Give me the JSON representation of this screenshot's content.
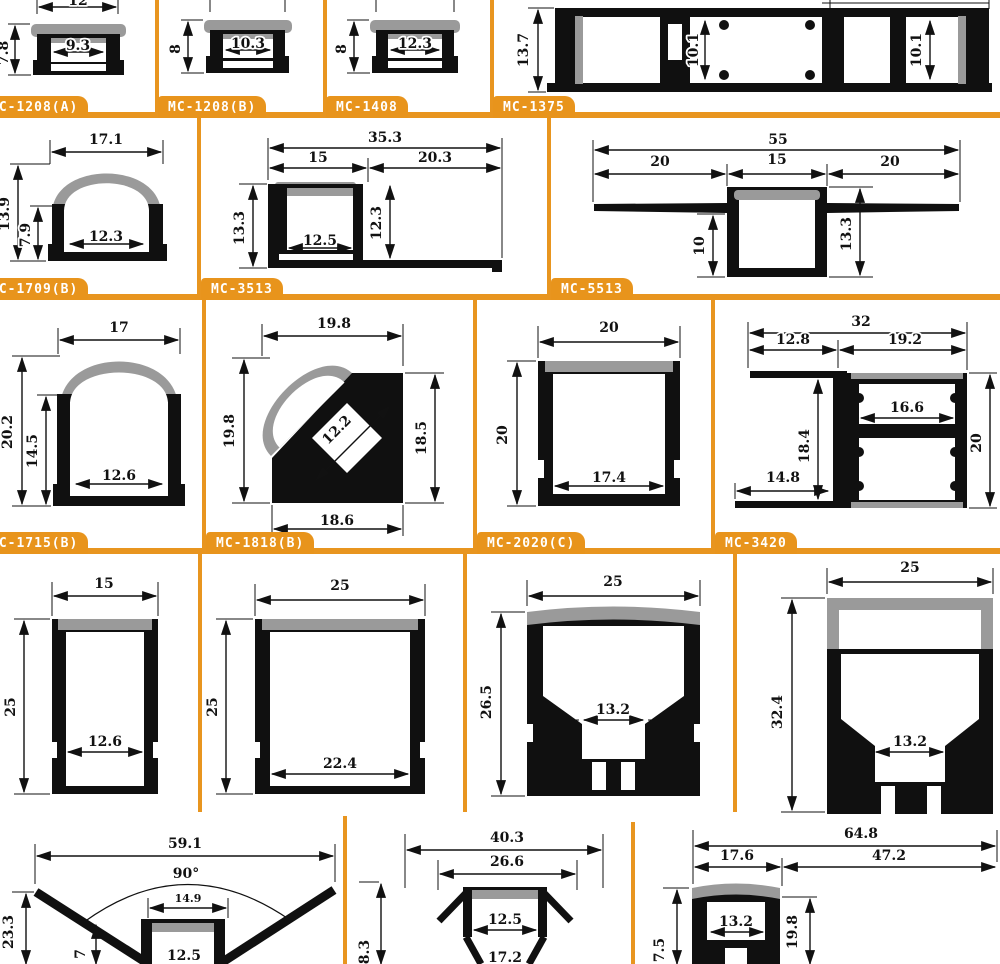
{
  "colors": {
    "accent": "#E8951F",
    "profile_body": "#101010",
    "lens_gray": "#9A9A9A",
    "dim_text": "#111111",
    "label_text": "#FFFFFF",
    "background": "#FFFFFF"
  },
  "profiles": {
    "mc1208a": {
      "label": "MC-1208(A)",
      "top": "12",
      "height": "7.8",
      "inner": "9.3"
    },
    "mc1208b": {
      "label": "MC-1208(B)",
      "height": "8",
      "inner": "10.3"
    },
    "mc1408": {
      "label": "MC-1408",
      "height": "8",
      "inner": "12.3"
    },
    "mc1375": {
      "label": "MC-1375",
      "height": "13.7",
      "slot_a": "10.1",
      "slot_b": "10.1"
    },
    "mc1709b": {
      "label": "MC-1709(B)",
      "top": "17.1",
      "height": "13.9",
      "inner_height": "7.9",
      "inner": "12.3"
    },
    "mc3513": {
      "label": "MC-3513",
      "total": "35.3",
      "left": "15",
      "right": "20.3",
      "height": "13.3",
      "inner": "12.5",
      "right_height": "12.3"
    },
    "mc5513": {
      "label": "MC-5513",
      "total": "55",
      "left": "20",
      "mid": "15",
      "right": "20",
      "depth": "10",
      "height": "13.3"
    },
    "mc1715b": {
      "label": "MC-1715(B)",
      "top": "17",
      "height": "20.2",
      "inner_height": "14.5",
      "inner": "12.6"
    },
    "mc1818b": {
      "label": "MC-1818(B)",
      "top": "19.8",
      "left": "19.8",
      "diag": "12.2",
      "right": "18.5",
      "bottom": "18.6"
    },
    "mc2020c": {
      "label": "MC-2020(C)",
      "top": "20",
      "height": "20",
      "inner": "17.4"
    },
    "mc3420": {
      "label": "MC-3420",
      "total": "32",
      "left": "12.8",
      "right": "19.2",
      "inner_height": "18.4",
      "bottom_left": "14.8",
      "inner": "16.6",
      "right_height": "20"
    },
    "p15x25": {
      "top": "15",
      "height": "25",
      "inner": "12.6"
    },
    "p25x25": {
      "top": "25",
      "height": "25",
      "inner": "22.4"
    },
    "p25x265": {
      "top": "25",
      "height": "26.5",
      "inner": "13.2"
    },
    "p25x324": {
      "top": "25",
      "height": "32.4",
      "inner": "13.2"
    },
    "corner59": {
      "total": "59.1",
      "angle": "90°",
      "slot_top": "14.9",
      "inner": "12.5",
      "height": "23.3",
      "inner_height": "7"
    },
    "p403": {
      "total": "40.3",
      "mid": "26.6",
      "inner": "12.5",
      "bottom": "17.2",
      "height": "8.3"
    },
    "p648": {
      "total": "64.8",
      "left": "17.6",
      "right": "47.2",
      "inner": "13.2",
      "right_height": "19.8",
      "height": "7.5"
    }
  }
}
